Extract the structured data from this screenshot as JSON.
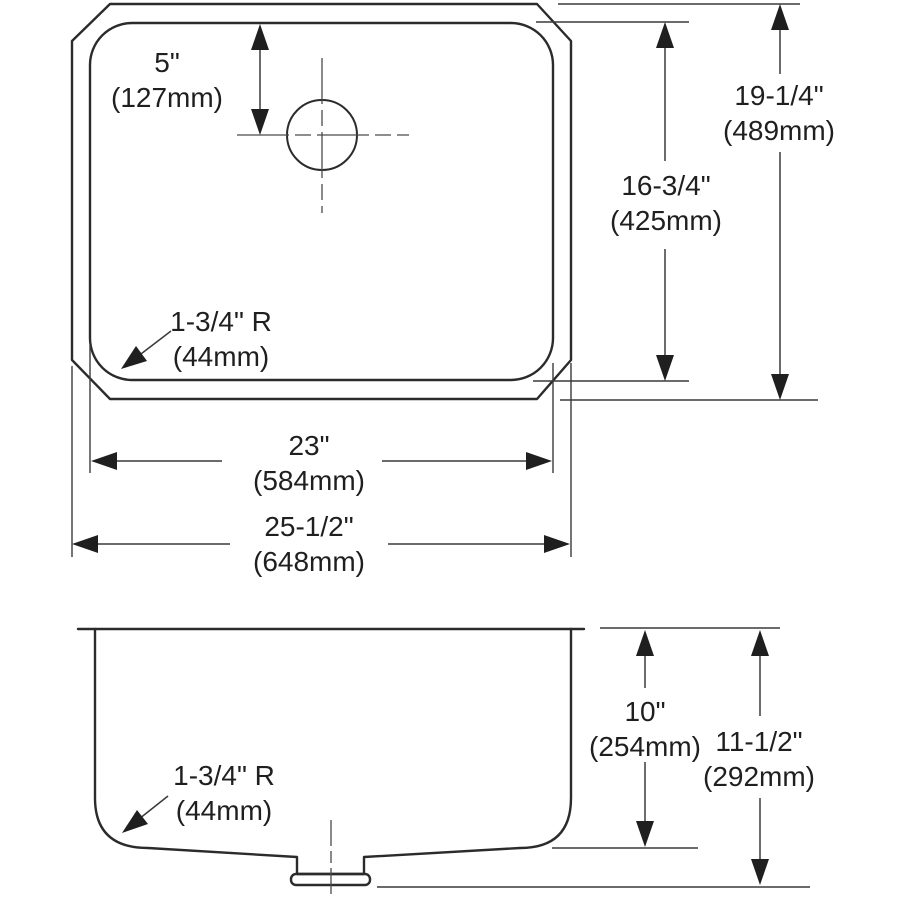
{
  "top_view": {
    "faucet_offset": {
      "in": "5\"",
      "mm": "(127mm)"
    },
    "corner_radius": {
      "in": "1-3/4\" R",
      "mm": "(44mm)"
    },
    "bowl_length": {
      "in": "23\"",
      "mm": "(584mm)"
    },
    "overall_length": {
      "in": "25-1/2\"",
      "mm": "(648mm)"
    },
    "bowl_width": {
      "in": "16-3/4\"",
      "mm": "(425mm)"
    },
    "overall_width": {
      "in": "19-1/4\"",
      "mm": "(489mm)"
    }
  },
  "side_view": {
    "corner_radius": {
      "in": "1-3/4\" R",
      "mm": "(44mm)"
    },
    "bowl_depth": {
      "in": "10\"",
      "mm": "(254mm)"
    },
    "overall_depth": {
      "in": "11-1/2\"",
      "mm": "(292mm)"
    }
  },
  "colors": {
    "line": "#2b2b2b",
    "background": "#ffffff"
  }
}
